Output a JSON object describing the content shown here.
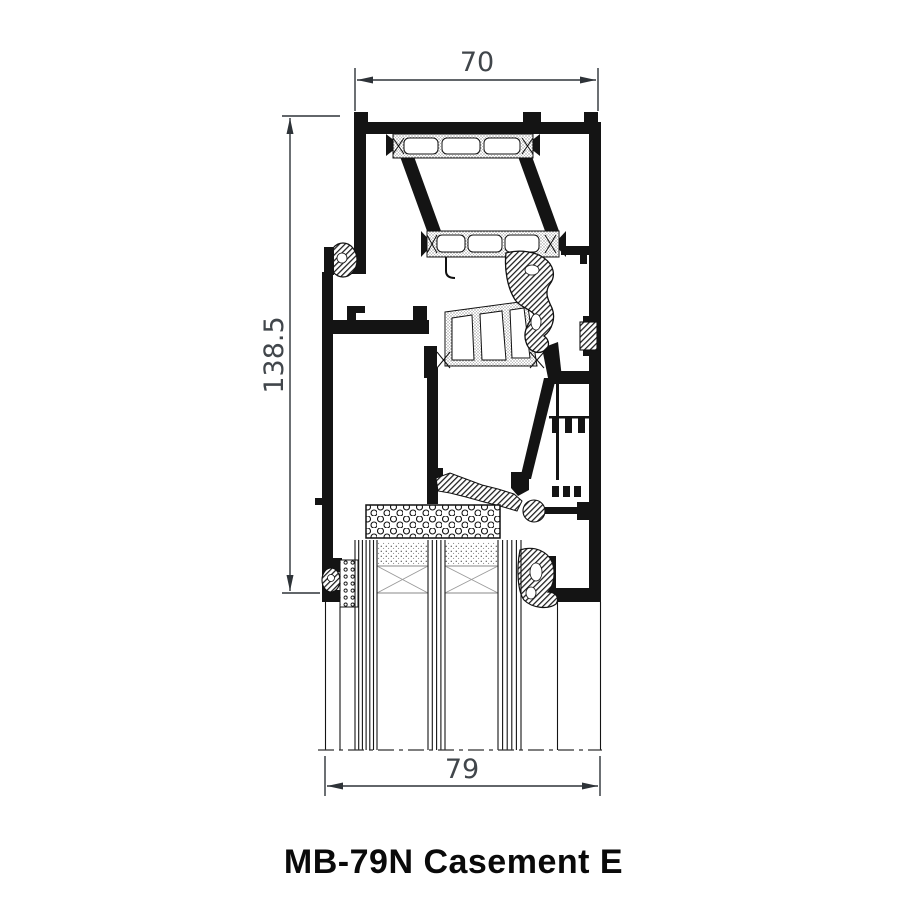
{
  "title": "MB-79N Casement E",
  "drawing": {
    "kind": "aluminium-window-profile-cross-section"
  },
  "dimensions": {
    "width_top": "70",
    "height_left": "138.5",
    "width_bottom": "79"
  },
  "colors": {
    "background": "#ffffff",
    "profile_line": "#141414",
    "dimension_line": "#2e3338",
    "dimension_text": "#41464b",
    "title_text": "#0a0a0a"
  }
}
